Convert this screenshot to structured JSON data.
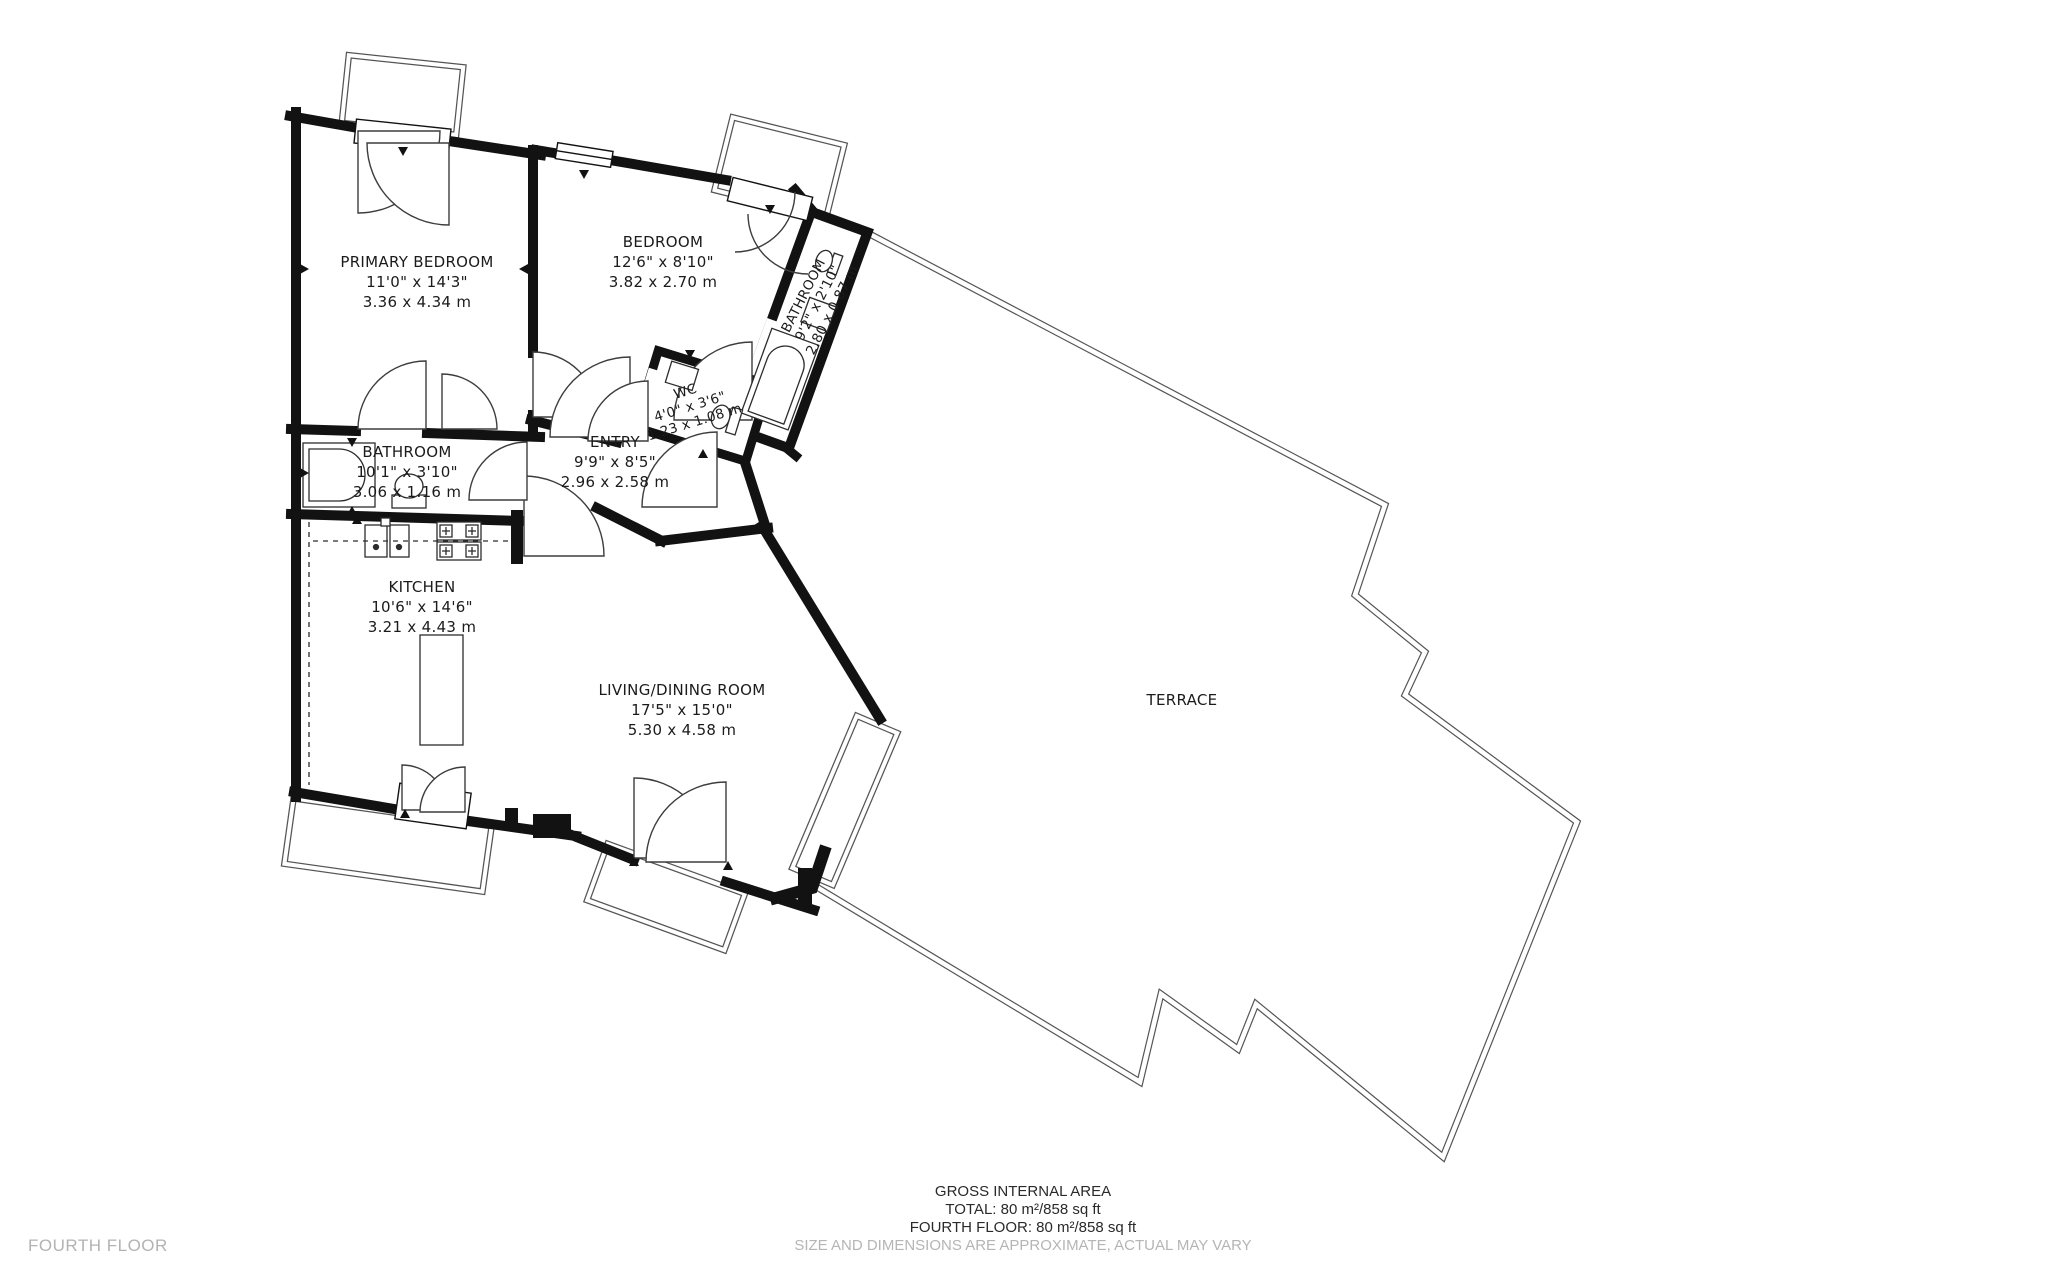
{
  "floor_plan_label": "FOURTH FLOOR",
  "rooms": [
    {
      "name": "PRIMARY BEDROOM",
      "dims_ft": "11'0\" x 14'3\"",
      "dims_m": "3.36 x 4.34 m"
    },
    {
      "name": "BEDROOM",
      "dims_ft": "12'6\" x 8'10\"",
      "dims_m": "3.82 x 2.70 m"
    },
    {
      "name": "BATHROOM",
      "dims_ft": "9'2\" x 2'10\"",
      "dims_m": "2.80 x 0.87 m"
    },
    {
      "name": "WC",
      "dims_ft": "4'0\" x 3'6\"",
      "dims_m": "1.23 x 1.08 m"
    },
    {
      "name": "ENTRY",
      "dims_ft": "9'9\" x 8'5\"",
      "dims_m": "2.96 x 2.58 m"
    },
    {
      "name": "BATHROOM",
      "dims_ft": "10'1\" x 3'10\"",
      "dims_m": "3.06 x 1.16 m"
    },
    {
      "name": "KITCHEN",
      "dims_ft": "10'6\" x 14'6\"",
      "dims_m": "3.21 x 4.43 m"
    },
    {
      "name": "LIVING/DINING ROOM",
      "dims_ft": "17'5\" x 15'0\"",
      "dims_m": "5.30 x 4.58 m"
    },
    {
      "name": "TERRACE"
    }
  ],
  "footer": {
    "title": "GROSS INTERNAL AREA",
    "total": "TOTAL: 80 m²/858 sq ft",
    "floor_total": "FOURTH FLOOR: 80 m²/858 sq ft",
    "disclaimer": "SIZE AND DIMENSIONS ARE APPROXIMATE, ACTUAL MAY VARY"
  },
  "colors": {
    "wall": "#121212",
    "thin_line": "#555555",
    "muted_text": "#b3b3b3"
  }
}
